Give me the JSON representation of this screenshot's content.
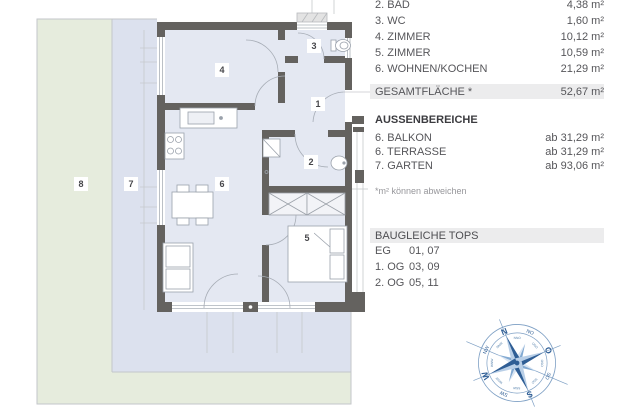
{
  "panel": {
    "rooms": [
      {
        "label": "2. BAD",
        "value": "4,38 m²"
      },
      {
        "label": "3. WC",
        "value": "1,60 m²"
      },
      {
        "label": "4. ZIMMER",
        "value": "10,12 m²"
      },
      {
        "label": "5. ZIMMER",
        "value": "10,59 m²"
      },
      {
        "label": "6. WOHNEN/KOCHEN",
        "value": "21,29 m²"
      }
    ],
    "total": {
      "label": "GESAMTFLÄCHE *",
      "value": "52,67 m²"
    },
    "outdoor": {
      "header": "AUSSENBEREICHE",
      "rows": [
        {
          "label": "6. BALKON",
          "value": "ab 31,29 m²"
        },
        {
          "label": "6. TERRASSE",
          "value": "ab 31,29 m²"
        },
        {
          "label": "7. GARTEN",
          "value": "ab 93,06 m²"
        }
      ],
      "footnote": "*m² können abweichen"
    },
    "identical_tops": {
      "header": "BAUGLEICHE TOPS",
      "rows": [
        {
          "label": "EG",
          "value": "01, 07"
        },
        {
          "label": "1. OG",
          "value": "03, 09"
        },
        {
          "label": "2. OG",
          "value": "05, 11"
        }
      ]
    }
  },
  "floorplan": {
    "room_labels": [
      {
        "number": "1",
        "x": 318,
        "y": 104
      },
      {
        "number": "2",
        "x": 311,
        "y": 162
      },
      {
        "number": "3",
        "x": 314,
        "y": 46
      },
      {
        "number": "4",
        "x": 222,
        "y": 70
      },
      {
        "number": "5",
        "x": 307,
        "y": 238
      },
      {
        "number": "6",
        "x": 222,
        "y": 184
      },
      {
        "number": "7",
        "x": 131,
        "y": 184
      },
      {
        "number": "8",
        "x": 81,
        "y": 184
      }
    ]
  },
  "compass": {
    "cardinals": [
      "N",
      "O",
      "S",
      "W"
    ],
    "ordinals": [
      "NO",
      "SO",
      "SW",
      "NW"
    ],
    "minors": [
      "NNO",
      "ONO",
      "OSO",
      "SSO",
      "SSW",
      "WSW",
      "WNW",
      "NNW"
    ]
  },
  "colors": {
    "garden_green": "#e6ecdd",
    "terrace_blue": "#dce1ee",
    "floor": "#e4e8f2",
    "wall": "#64625f",
    "highlight_bar": "#ececed",
    "compass_dark_blue": "#2f5e95",
    "compass_light_blue": "#b9cfe7"
  }
}
